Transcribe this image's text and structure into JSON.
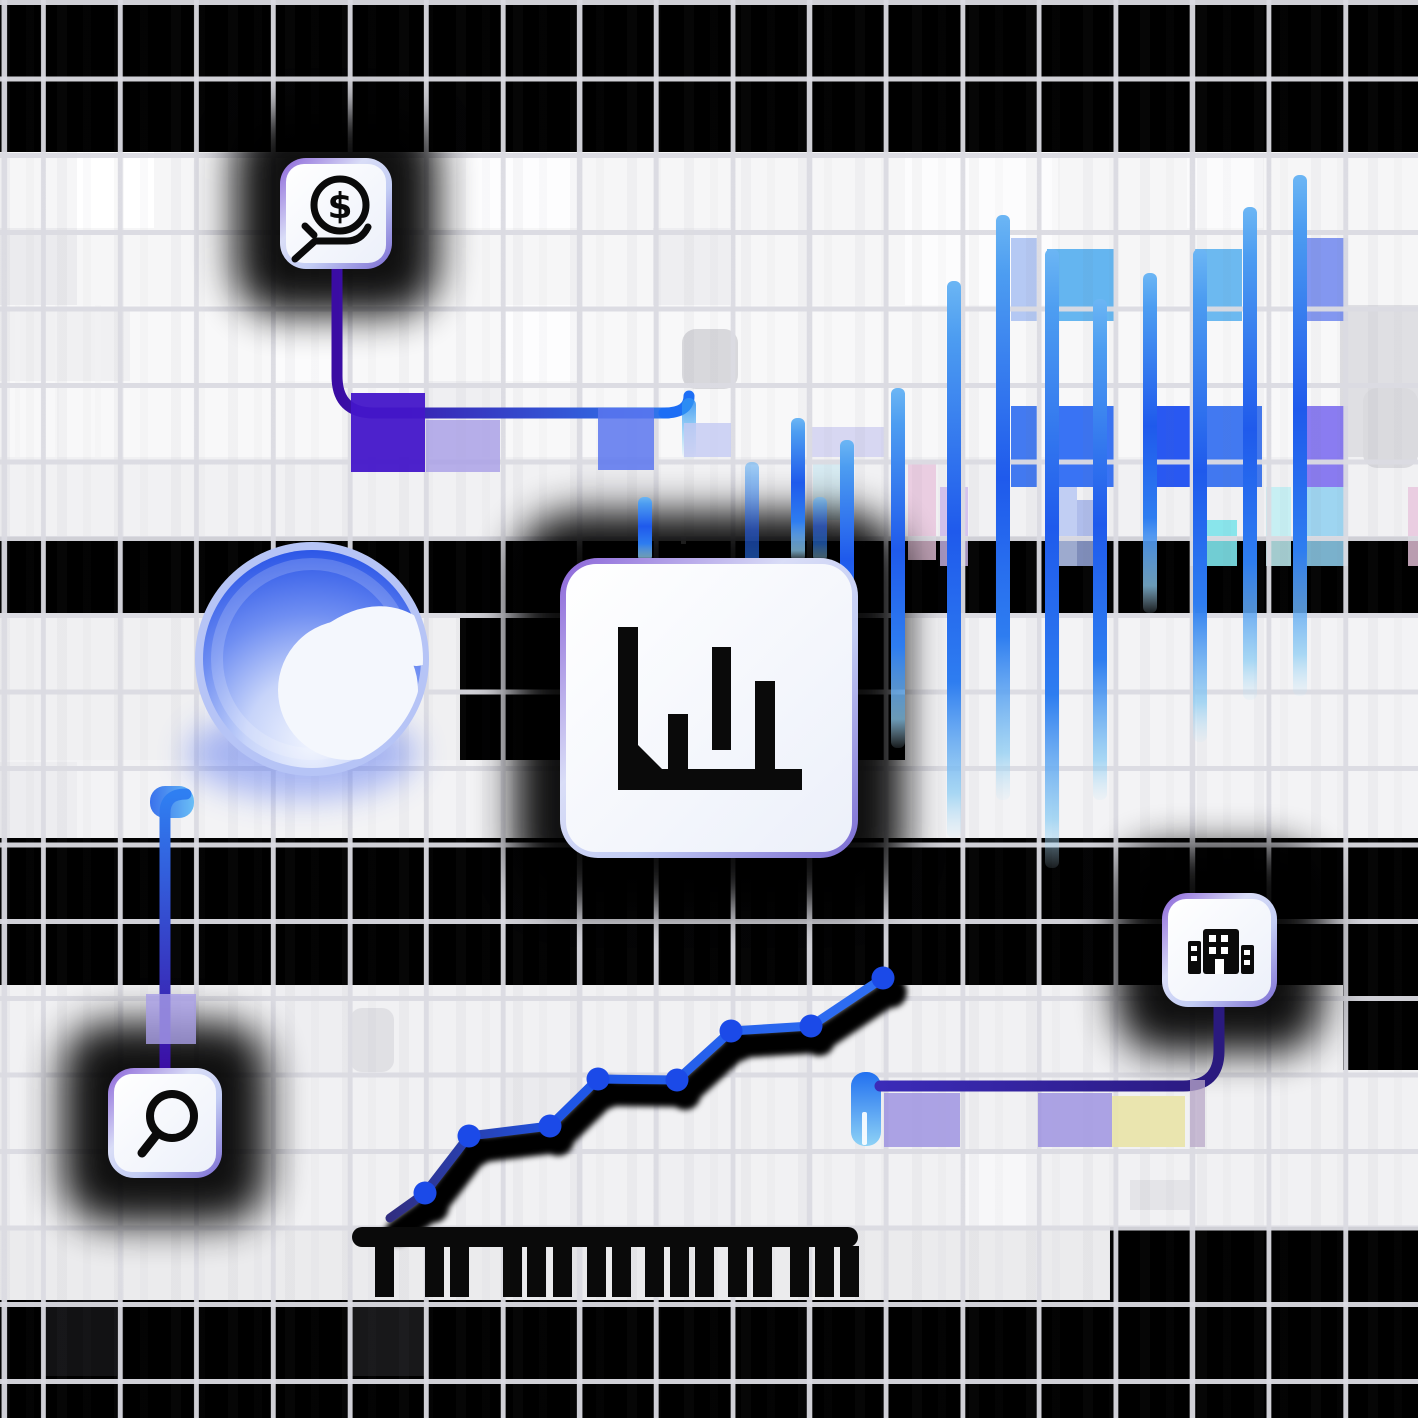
{
  "meta": {
    "description": "Decorative fintech analytics illustration: four icon cards (coin-in-hand, bar chart, office building, magnifier) linked by rounded connector lines over a grid, with a blue gradient sphere, gradient bar columns, an ascending dotted line chart and a black comb/ruler shape",
    "title": "",
    "visible_text": []
  },
  "scene": {
    "width": 1418,
    "height": 1418,
    "background": "#000000"
  },
  "grid": {
    "pitch": 76.6,
    "v_offset": 41,
    "thickness": 5,
    "color": "#dbdbe2"
  },
  "palette": {
    "accent_blue": "#2563eb",
    "sky_blue": "#54aeee",
    "indigo": "#4316c9",
    "deep_indigo": "#2a1a7e",
    "lavender": "#a79ee6",
    "pale_yellow": "#e9e3a7",
    "card_border_purple": "#8a63d8",
    "card_bg": "#f7f9fe",
    "black_ink": "#0a0a0a"
  },
  "bands": [
    {
      "x": 0,
      "y": 152,
      "w": 1418,
      "h": 153,
      "c": "#f6f6f7"
    },
    {
      "x": 0,
      "y": 305,
      "w": 1418,
      "h": 152,
      "c": "#f8f8f9"
    },
    {
      "x": 0,
      "y": 457,
      "w": 1418,
      "h": 80,
      "c": "#f1f1f3"
    },
    {
      "x": 0,
      "y": 613,
      "w": 460,
      "h": 147,
      "c": "#f0f0f2"
    },
    {
      "x": 905,
      "y": 613,
      "w": 513,
      "h": 147,
      "c": "#f3f3f5"
    },
    {
      "x": 0,
      "y": 760,
      "w": 1418,
      "h": 78,
      "c": "#f3f3f5"
    },
    {
      "x": 0,
      "y": 985,
      "w": 1418,
      "h": 242,
      "c": "#f1f1f3"
    },
    {
      "x": 0,
      "y": 1227,
      "w": 1110,
      "h": 73,
      "c": "#ebebed"
    }
  ],
  "cells": [
    {
      "x": 77,
      "y": 152,
      "w": 77,
      "h": 76,
      "c": "#ffffff"
    },
    {
      "x": 424,
      "y": 152,
      "w": 153,
      "h": 76,
      "c": "#fdfdfe"
    },
    {
      "x": 905,
      "y": 152,
      "w": 153,
      "h": 153,
      "c": "#fcfcfd"
    },
    {
      "x": 1187,
      "y": 152,
      "w": 76,
      "h": 76,
      "c": "#fbfbfc"
    },
    {
      "x": 0,
      "y": 228,
      "w": 77,
      "h": 77,
      "c": "#ebebee"
    },
    {
      "x": 347,
      "y": 228,
      "w": 77,
      "h": 77,
      "c": "#ececef"
    },
    {
      "x": 653,
      "y": 228,
      "w": 77,
      "h": 77,
      "c": "#eeeef1"
    },
    {
      "x": 0,
      "y": 311,
      "w": 130,
      "h": 70,
      "c": "#f0f0f2"
    },
    {
      "x": 270,
      "y": 305,
      "w": 77,
      "h": 76,
      "c": "#fbfbfc"
    },
    {
      "x": 500,
      "y": 305,
      "w": 77,
      "h": 76,
      "c": "#fdfdfe"
    },
    {
      "x": 1340,
      "y": 305,
      "w": 78,
      "h": 152,
      "c": "#dfdfe3"
    },
    {
      "x": 424,
      "y": 381,
      "w": 76,
      "h": 76,
      "c": "#efeff2"
    },
    {
      "x": 577,
      "y": 457,
      "w": 77,
      "h": 80,
      "c": "#ebebee"
    },
    {
      "x": 0,
      "y": 762,
      "w": 77,
      "h": 76,
      "c": "#ededf0"
    },
    {
      "x": 730,
      "y": 762,
      "w": 77,
      "h": 76,
      "c": "#fafafb"
    },
    {
      "x": 270,
      "y": 985,
      "w": 77,
      "h": 90,
      "c": "#eeeef1"
    },
    {
      "x": 1110,
      "y": 985,
      "w": 80,
      "h": 90,
      "c": "#ebebee"
    },
    {
      "x": 500,
      "y": 1075,
      "w": 77,
      "h": 75,
      "c": "#ebebee"
    },
    {
      "x": 653,
      "y": 1150,
      "w": 80,
      "h": 77,
      "c": "#efeff2"
    },
    {
      "x": 960,
      "y": 1150,
      "w": 77,
      "h": 77,
      "c": "#f7f7f9"
    },
    {
      "x": 1130,
      "y": 1180,
      "w": 60,
      "h": 30,
      "c": "#e4e4e8"
    },
    {
      "x": 1343,
      "y": 985,
      "w": 75,
      "h": 85,
      "c": "#000000"
    },
    {
      "x": 681,
      "y": 518,
      "w": 5,
      "h": 26,
      "c": "#f0f0f0"
    },
    {
      "x": 41,
      "y": 1300,
      "w": 76,
      "h": 76,
      "c": "#121214"
    },
    {
      "x": 347,
      "y": 1300,
      "w": 77,
      "h": 76,
      "c": "#18181a"
    }
  ],
  "ghost_shapes": [
    {
      "x": 682,
      "y": 329,
      "w": 56,
      "h": 60,
      "r": 14,
      "c": "#d8d8dc"
    },
    {
      "x": 1363,
      "y": 388,
      "w": 55,
      "h": 80,
      "r": 14,
      "c": "#dadade"
    },
    {
      "x": 350,
      "y": 1008,
      "w": 44,
      "h": 64,
      "r": 12,
      "c": "#e0e0e4"
    }
  ],
  "tints": [
    {
      "x": 1011,
      "y": 238,
      "w": 26,
      "h": 83,
      "c": "#9db8f0",
      "o": 0.75
    },
    {
      "x": 1047,
      "y": 249,
      "w": 67,
      "h": 72,
      "c": "#54aeee",
      "o": 0.9
    },
    {
      "x": 1195,
      "y": 249,
      "w": 47,
      "h": 72,
      "c": "#54aeee",
      "o": 0.85
    },
    {
      "x": 1306,
      "y": 238,
      "w": 42,
      "h": 83,
      "c": "#6f86ef",
      "o": 0.85
    },
    {
      "x": 1011,
      "y": 406,
      "w": 26,
      "h": 81,
      "c": "#2f6bf0",
      "o": 0.9
    },
    {
      "x": 1047,
      "y": 406,
      "w": 67,
      "h": 81,
      "c": "#2e6cf3",
      "o": 0.95
    },
    {
      "x": 1145,
      "y": 406,
      "w": 45,
      "h": 81,
      "c": "#1d4ff0",
      "o": 0.95
    },
    {
      "x": 1195,
      "y": 406,
      "w": 67,
      "h": 81,
      "c": "#2e6af0",
      "o": 0.9
    },
    {
      "x": 1306,
      "y": 406,
      "w": 42,
      "h": 81,
      "c": "#7d6ef0",
      "o": 0.9
    },
    {
      "x": 810,
      "y": 427,
      "w": 75,
      "h": 30,
      "c": "#c9c9f0",
      "o": 0.7
    },
    {
      "x": 813,
      "y": 460,
      "w": 34,
      "h": 60,
      "c": "#cfe8f0",
      "o": 0.8
    },
    {
      "x": 908,
      "y": 460,
      "w": 28,
      "h": 100,
      "c": "#e8c4dc",
      "o": 0.8
    },
    {
      "x": 940,
      "y": 487,
      "w": 28,
      "h": 79,
      "c": "#cdb8ec",
      "o": 0.8
    },
    {
      "x": 1047,
      "y": 487,
      "w": 30,
      "h": 79,
      "c": "#b9c8f2",
      "o": 0.85
    },
    {
      "x": 1077,
      "y": 500,
      "w": 28,
      "h": 66,
      "c": "#9fb0e8",
      "o": 0.8
    },
    {
      "x": 1190,
      "y": 520,
      "w": 47,
      "h": 46,
      "c": "#7de3ea",
      "o": 0.9
    },
    {
      "x": 1266,
      "y": 487,
      "w": 25,
      "h": 79,
      "c": "#bfeef2",
      "o": 0.85
    },
    {
      "x": 1306,
      "y": 487,
      "w": 42,
      "h": 79,
      "c": "#8fd0f0",
      "o": 0.85
    },
    {
      "x": 1408,
      "y": 487,
      "w": 10,
      "h": 79,
      "c": "#e8c4dc",
      "o": 0.8
    }
  ],
  "chart_data": [
    {
      "type": "bar",
      "title": "decorative gradient bar columns",
      "bar_width": 14,
      "items": [
        {
          "x": 645,
          "top": 497,
          "bottom": 562
        },
        {
          "x": 752,
          "top": 462,
          "bottom": 613,
          "soft": true
        },
        {
          "x": 798,
          "top": 418,
          "bottom": 562
        },
        {
          "x": 820,
          "top": 497,
          "bottom": 562,
          "soft": true
        },
        {
          "x": 847,
          "top": 440,
          "bottom": 705
        },
        {
          "x": 898,
          "top": 388,
          "bottom": 748
        },
        {
          "x": 954,
          "top": 281,
          "bottom": 838
        },
        {
          "x": 1003,
          "top": 215,
          "bottom": 800
        },
        {
          "x": 1052,
          "top": 249,
          "bottom": 868
        },
        {
          "x": 1100,
          "top": 299,
          "bottom": 800
        },
        {
          "x": 1150,
          "top": 273,
          "bottom": 613
        },
        {
          "x": 1200,
          "top": 249,
          "bottom": 742
        },
        {
          "x": 1250,
          "top": 207,
          "bottom": 700
        },
        {
          "x": 1300,
          "top": 175,
          "bottom": 696
        }
      ]
    },
    {
      "type": "line",
      "title": "decorative ascending line chart with dots",
      "points": [
        [
          390,
          1218
        ],
        [
          425,
          1193
        ],
        [
          469,
          1136
        ],
        [
          550,
          1126
        ],
        [
          598,
          1079
        ],
        [
          677,
          1080
        ],
        [
          731,
          1031
        ],
        [
          811,
          1026
        ],
        [
          883,
          978
        ]
      ],
      "dot_radius": 11.5,
      "line_width": 9,
      "color_start": "#312e81",
      "color_end": "#2f6ff2",
      "dot_color": "#1b4ae8"
    }
  ],
  "sphere": {
    "cx": 312,
    "cy": 659,
    "r": 117,
    "top_color": "#1c49e4",
    "mid_color": "#6f8ef2",
    "light_color": "#f0f4fe",
    "ring_color": "#b6c4f6",
    "blob_color": "#f4f7fd"
  },
  "cards": [
    {
      "id": "money-hand",
      "x": 280,
      "y": 158,
      "w": 112,
      "h": 111,
      "r": 26,
      "icon": "hand-coin-icon",
      "symbol": "$"
    },
    {
      "id": "bar-chart",
      "x": 560,
      "y": 558,
      "w": 298,
      "h": 300,
      "r": 38,
      "icon": "bar-chart-icon"
    },
    {
      "id": "building",
      "x": 1162,
      "y": 893,
      "w": 115,
      "h": 114,
      "r": 26,
      "icon": "building-icon"
    },
    {
      "id": "search",
      "x": 108,
      "y": 1068,
      "w": 114,
      "h": 110,
      "r": 26,
      "icon": "magnifier-icon"
    }
  ],
  "connectors": [
    {
      "id": "money-connector",
      "path": "M 337 267 L 337 376 Q 337 413 374 413 L 668 413",
      "from": "#3a0ca3",
      "to": "#2f7ff2",
      "gx1": 337,
      "gy1": 413,
      "gx2": 690,
      "gy2": 413,
      "hook": {
        "path": "M 664 413 Q 689 413 689 396",
        "c1": "#1d6ef5",
        "c2": "#38bdf8",
        "tail": {
          "x": 682,
          "y": 398,
          "w": 14,
          "h": 62
        }
      }
    },
    {
      "id": "search-connector",
      "path": "M 165 1068 L 165 813 Q 165 794 186 794",
      "from": "#2f7ff2",
      "to": "#3b0fa5",
      "gx1": 165,
      "gy1": 794,
      "gx2": 165,
      "gy2": 1068,
      "cap": {
        "x": 150,
        "y": 786,
        "w": 44,
        "h": 32
      }
    },
    {
      "id": "building-connector",
      "path": "M 1219 1006 L 1219 1051 Q 1219 1086 1183 1086 L 880 1086",
      "from": "#3b2bb8",
      "to": "#2a1a7e",
      "gx1": 880,
      "gy1": 1086,
      "gx2": 1219,
      "gy2": 1086,
      "stub": {
        "x": 851,
        "y": 1072,
        "w": 30,
        "h": 74
      },
      "slit": {
        "x": 862,
        "y": 1112,
        "w": 5,
        "h": 33
      }
    }
  ],
  "connector_overlays": [
    {
      "x": 351,
      "y": 393,
      "w": 74,
      "h": 79,
      "c": "#4316c9",
      "o": 0.95
    },
    {
      "x": 426,
      "y": 420,
      "w": 74,
      "h": 52,
      "c": "#a79ee6",
      "o": 0.8
    },
    {
      "x": 598,
      "y": 408,
      "w": 56,
      "h": 62,
      "c": "#5b76ee",
      "o": 0.85
    },
    {
      "x": 684,
      "y": 423,
      "w": 47,
      "h": 34,
      "c": "#c3c9f2",
      "o": 0.8
    },
    {
      "x": 146,
      "y": 994,
      "w": 50,
      "h": 50,
      "c": "#a79ee6",
      "o": 0.8
    },
    {
      "x": 884,
      "y": 1093,
      "w": 76,
      "h": 54,
      "c": "#9a8fe0",
      "o": 0.8
    },
    {
      "x": 1038,
      "y": 1093,
      "w": 74,
      "h": 54,
      "c": "#9a8fe0",
      "o": 0.8
    },
    {
      "x": 1112,
      "y": 1096,
      "w": 73,
      "h": 51,
      "c": "#e9e3a7",
      "o": 0.9
    },
    {
      "x": 1190,
      "y": 1080,
      "w": 15,
      "h": 67,
      "c": "#b9a8c8",
      "o": 0.75
    }
  ],
  "comb": {
    "bar": {
      "x": 352,
      "y": 1227,
      "w": 506,
      "h": 20,
      "r": 10
    },
    "tooth_w": 19,
    "tooth_h": 51,
    "tooth_y": 1246,
    "teeth_x": [
      375,
      425,
      450,
      503,
      527,
      553,
      587,
      612,
      645,
      670,
      695,
      728,
      753,
      790,
      815,
      840
    ]
  },
  "stripe_columns": [
    {
      "x": 15,
      "y": 305,
      "w": 5,
      "h": 152
    },
    {
      "x": 55,
      "y": 305,
      "w": 4,
      "h": 152
    },
    {
      "x": 95,
      "y": 305,
      "w": 6,
      "h": 152
    }
  ]
}
